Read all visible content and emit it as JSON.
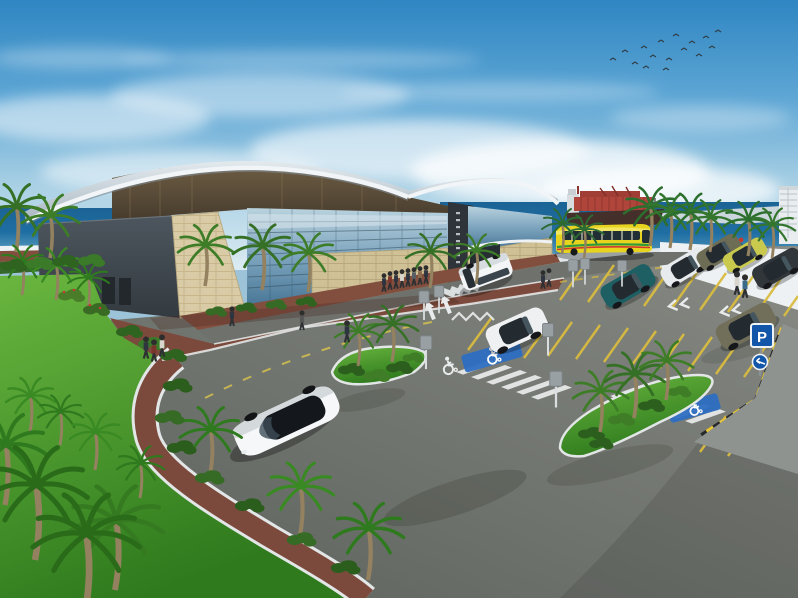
{
  "scene": {
    "title": "Seaside cruise terminal architectural rendering",
    "description": "Terminal building with twin curved roofs, glass and stone facades, red-paved promenade, palm landscaping, angle parking lot with accessible bays, yellow tour coach, white shu ttle van, parked cars, container ship and coastline on the horizon, flock of birds in a blue sky",
    "signs": {
      "parking": "P"
    },
    "palette": {
      "sky_top": "#2f86c2",
      "sky_horizon": "#dcebf2",
      "ocean": "#1b6395",
      "roof_gray": "#c2ccd3",
      "wall_dark": "#434b52",
      "stone_beige": "#d9cba6",
      "glass_blue": "#7fa6bf",
      "plaza_red": "#7c4a3c",
      "asphalt_gray": "#73766f",
      "grass_green": "#55a636",
      "palm_green": "#3e7d27",
      "bay_line_yellow": "#d9bc3f",
      "accessible_blue": "#2d6fc2",
      "ship_red": "#b0453c",
      "bus_yellow": "#e6d41f",
      "sign_blue": "#1156a8",
      "seawall_white": "#edf1f3"
    },
    "landmarks": {
      "terminal_building": "curved-roof glass and stone terminal",
      "container_ship": "red container ship at sea",
      "tour_bus": "yellow coach on the seafront road",
      "parking_lot": "yellow angle bays with accessible spaces and crosswalks"
    }
  }
}
